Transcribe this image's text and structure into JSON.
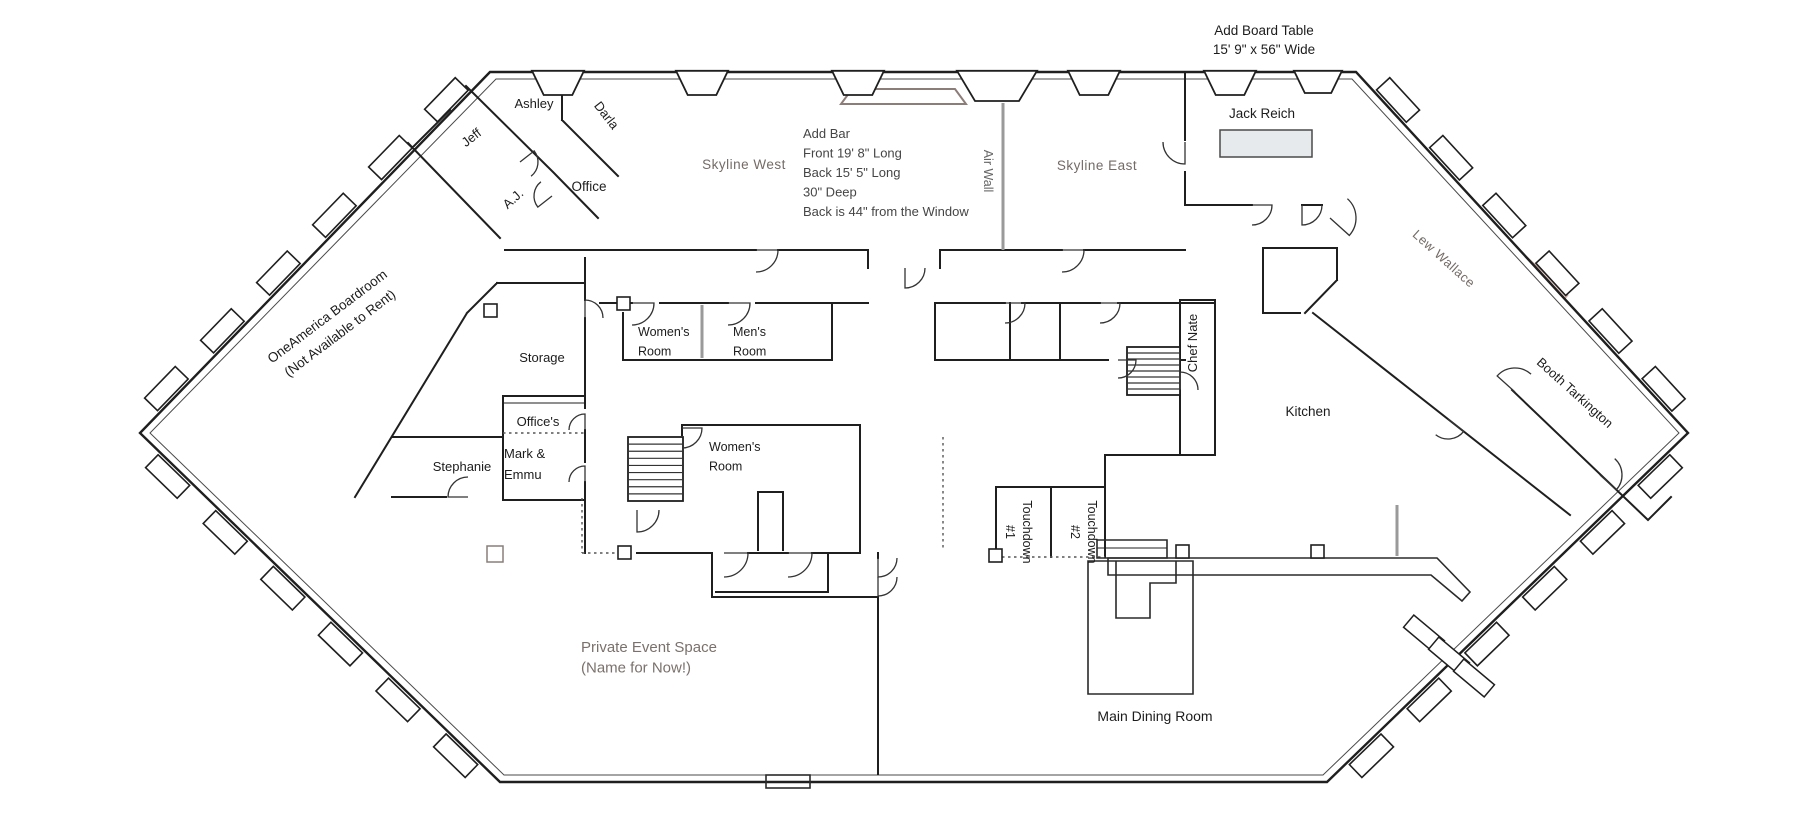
{
  "annotations": {
    "board_table": "Add Board Table\n15' 9\" x 56\" Wide",
    "add_bar": "Add Bar\nFront 19' 8\" Long\nBack 15' 5\" Long\n30\" Deep\nBack is 44\" from the Window",
    "air_wall": "Air Wall"
  },
  "rooms": {
    "ashley": "Ashley",
    "darla": "Darla",
    "jeff": "Jeff",
    "aj": "A.J.",
    "office": "Office",
    "skyline_west": "Skyline West",
    "skyline_east": "Skyline East",
    "jack_reich": "Jack Reich",
    "lew_wallace": "Lew Wallace",
    "booth_tarkington": "Booth Tarkington",
    "oneamerica": "OneAmerica Boardroom\n(Not Available to Rent)",
    "storage": "Storage",
    "offices": "Office's",
    "mark_emmu": "Mark &\nEmmu",
    "stephanie": "Stephanie",
    "womens1": "Women's\nRoom",
    "mens": "Men's\nRoom",
    "womens2": "Women's\nRoom",
    "chef_nate": "Chef Nate",
    "kitchen": "Kitchen",
    "touchdown1": "Touchdown\n#1",
    "touchdown2": "Touchdown\n#2",
    "main_dining": "Main Dining Room",
    "private_event": "Private Event Space\n(Name for Now!)"
  },
  "colors": {
    "shaded": "#ecd3cc",
    "shaded_border": "#c5a197",
    "wall": "#1f1f1f",
    "gray_label": "#746b66",
    "note_text": "#454545",
    "air_wall_line": "#9a9a9a",
    "table_fill": "#e6eaec",
    "bar_outline": "#8d7d79"
  }
}
